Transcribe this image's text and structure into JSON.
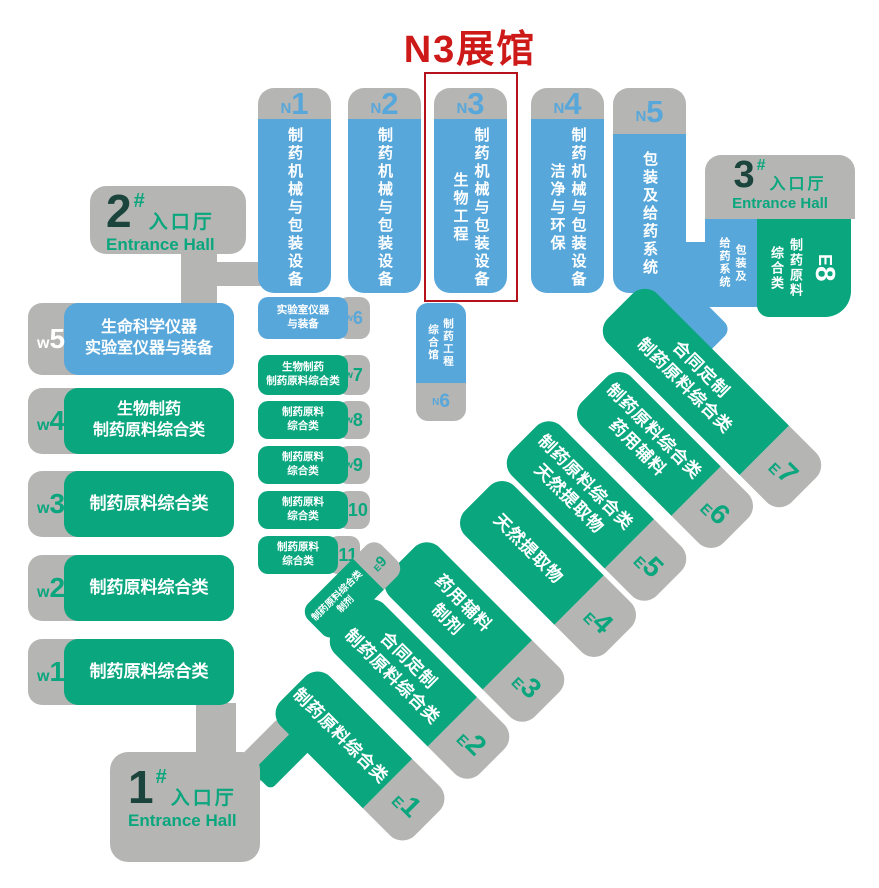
{
  "title": "N3展馆",
  "colors": {
    "blue": "#58A7DB",
    "green": "#0AA67E",
    "gray": "#B5B5B3",
    "dark_teal": "#1B453C",
    "red": "#CD1A19"
  },
  "entrances": {
    "one": {
      "num": "1",
      "hash": "#",
      "cn": "入口厅",
      "en": "Entrance Hall"
    },
    "two": {
      "num": "2",
      "hash": "#",
      "cn": "入口厅",
      "en": "Entrance Hall"
    },
    "three": {
      "num": "3",
      "hash": "#",
      "cn": "入口厅",
      "en": "Entrance Hall"
    }
  },
  "n_halls": [
    {
      "prefix": "N",
      "num": "1",
      "lines": [
        "制药机械与包装设备"
      ]
    },
    {
      "prefix": "N",
      "num": "2",
      "lines": [
        "制药机械与包装设备"
      ]
    },
    {
      "prefix": "N",
      "num": "3",
      "lines": [
        "制药机械与包装设备",
        "生物工程"
      ],
      "highlighted": true
    },
    {
      "prefix": "N",
      "num": "4",
      "lines": [
        "制药机械与包装设备",
        "洁净与环保"
      ]
    },
    {
      "prefix": "N",
      "num": "5",
      "lines": [
        "包装及给药系统"
      ]
    }
  ],
  "n6": {
    "prefix": "N",
    "num": "6",
    "lines": [
      "制药工程",
      "综合馆"
    ]
  },
  "w_left": [
    {
      "prefix": "w",
      "num": "5",
      "lines": [
        "生命科学仪器",
        "实验室仪器与装备"
      ]
    },
    {
      "prefix": "w",
      "num": "4",
      "lines": [
        "生物制药",
        "制药原料综合类"
      ]
    },
    {
      "prefix": "w",
      "num": "3",
      "lines": [
        "制药原料综合类"
      ]
    },
    {
      "prefix": "w",
      "num": "2",
      "lines": [
        "制药原料综合类"
      ]
    },
    {
      "prefix": "w",
      "num": "1",
      "lines": [
        "制药原料综合类"
      ]
    }
  ],
  "w_mid": [
    {
      "prefix": "w",
      "num": "6",
      "lines": [
        "实验室仪器",
        "与装备"
      ]
    },
    {
      "prefix": "w",
      "num": "7",
      "lines": [
        "生物制药",
        "制药原料综合类"
      ]
    },
    {
      "prefix": "w",
      "num": "8",
      "lines": [
        "制药原料",
        "综合类"
      ]
    },
    {
      "prefix": "w",
      "num": "9",
      "lines": [
        "制药原料",
        "综合类"
      ]
    },
    {
      "prefix": "w",
      "num": "10",
      "lines": [
        "制药原料",
        "综合类"
      ]
    },
    {
      "prefix": "w",
      "num": "11",
      "lines": [
        "制药原料",
        "综合类"
      ]
    }
  ],
  "hall3_blue": {
    "lines": [
      "包装及",
      "给药系统"
    ]
  },
  "e8": {
    "prefix": "E",
    "num": "8",
    "lines": [
      "制药原料",
      "综合类"
    ]
  },
  "e_bars": [
    {
      "prefix": "E",
      "num": "7",
      "lines": [
        "合同定制",
        "制药原料综合类"
      ]
    },
    {
      "prefix": "E",
      "num": "6",
      "lines": [
        "制药原料综合类",
        "药用辅料"
      ]
    },
    {
      "prefix": "E",
      "num": "5",
      "lines": [
        "制药原料综合类",
        "天然提取物"
      ]
    },
    {
      "prefix": "E",
      "num": "4",
      "lines": [
        "天然提取物"
      ]
    },
    {
      "prefix": "E",
      "num": "3",
      "lines": [
        "药用辅料",
        "制剂"
      ]
    },
    {
      "prefix": "E",
      "num": "2",
      "lines": [
        "合同定制",
        "制药原料综合类"
      ]
    },
    {
      "prefix": "E",
      "num": "1",
      "lines": [
        "制药原料综合类"
      ]
    },
    {
      "prefix": "E",
      "num": "9",
      "lines": [
        "制药原料综合类",
        "制剂"
      ]
    }
  ]
}
